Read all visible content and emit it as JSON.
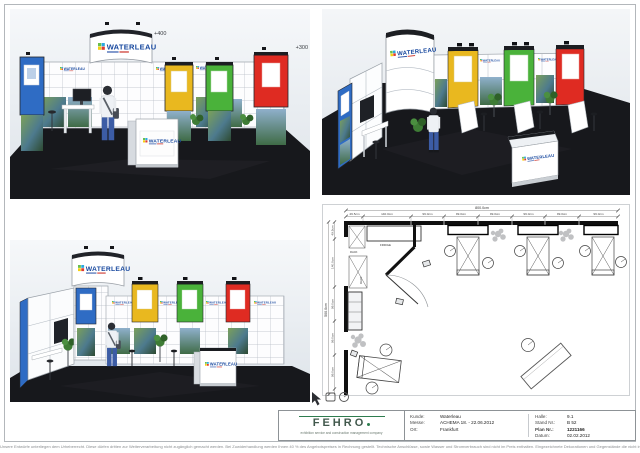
{
  "document": {
    "brand": {
      "name": "WATERLEAU"
    },
    "annotations": {
      "height_400": "+400",
      "height_300": "+300"
    },
    "colors": {
      "panel-blue": "#2f6cc4",
      "panel-yellow": "#e9b81f",
      "panel-green": "#4ab23a",
      "panel-red": "#df2b22",
      "brand-blue": "#16479e",
      "fehro-green": "#2e7d4f",
      "floor-dark": "#17181c"
    }
  },
  "floor_plan": {
    "top_total": "800.0cm",
    "top_dims": [
      "49.5cm",
      "140.0cm",
      "99.0cm",
      "99.0cm",
      "99.0cm",
      "99.0cm",
      "99.0cm",
      "99.0cm"
    ],
    "left_total": "500.0cm",
    "left_dims": [
      "49.5cm",
      "140.0cm",
      "99.0cm",
      "99.0cm",
      "99.0cm"
    ],
    "labels": {
      "rack_top": "RACK",
      "fridge": "FRIDGE",
      "rack_side": "RACK"
    }
  },
  "title_block": {
    "logo": "FEHRO",
    "tagline": "exhibition service and construction management company",
    "fields_left": [
      {
        "label": "Kunde:",
        "value": "Waterleau"
      },
      {
        "label": "Messe:",
        "value": "ACHEMA 18. - 22.06.2012"
      },
      {
        "label": "Ort:",
        "value": "Frankfurt"
      }
    ],
    "fields_right": [
      {
        "label": "Halle:",
        "value": "9.1"
      },
      {
        "label": "Stand Nr.:",
        "value": "B 52"
      },
      {
        "label": "Plan Nr.:",
        "value": "1221166"
      },
      {
        "label": "Datum:",
        "value": "02.02.2012"
      }
    ]
  },
  "footer": {
    "disclaimer": "Unsere Entwürfe unterliegen dem Urheberrecht. Diese dürfen dritten zur Weiterverarbeitung nicht zugänglich gemacht werden. Bei Zuwiderhandlung werden Ihnen 40 % des Angebotspreises in Rechnung gestellt. Technische Anschlüsse, sowie Wasser und Stromverbrauch sind nicht im Preis enthalten. Eingezeichnete Dekorationen und Gegenstände die nicht in der Leistungsbeschreibung enthalten sind, gehören nicht zum Lieferumfang. Änderungen durch die Messe bleiben vorbehalten."
  }
}
